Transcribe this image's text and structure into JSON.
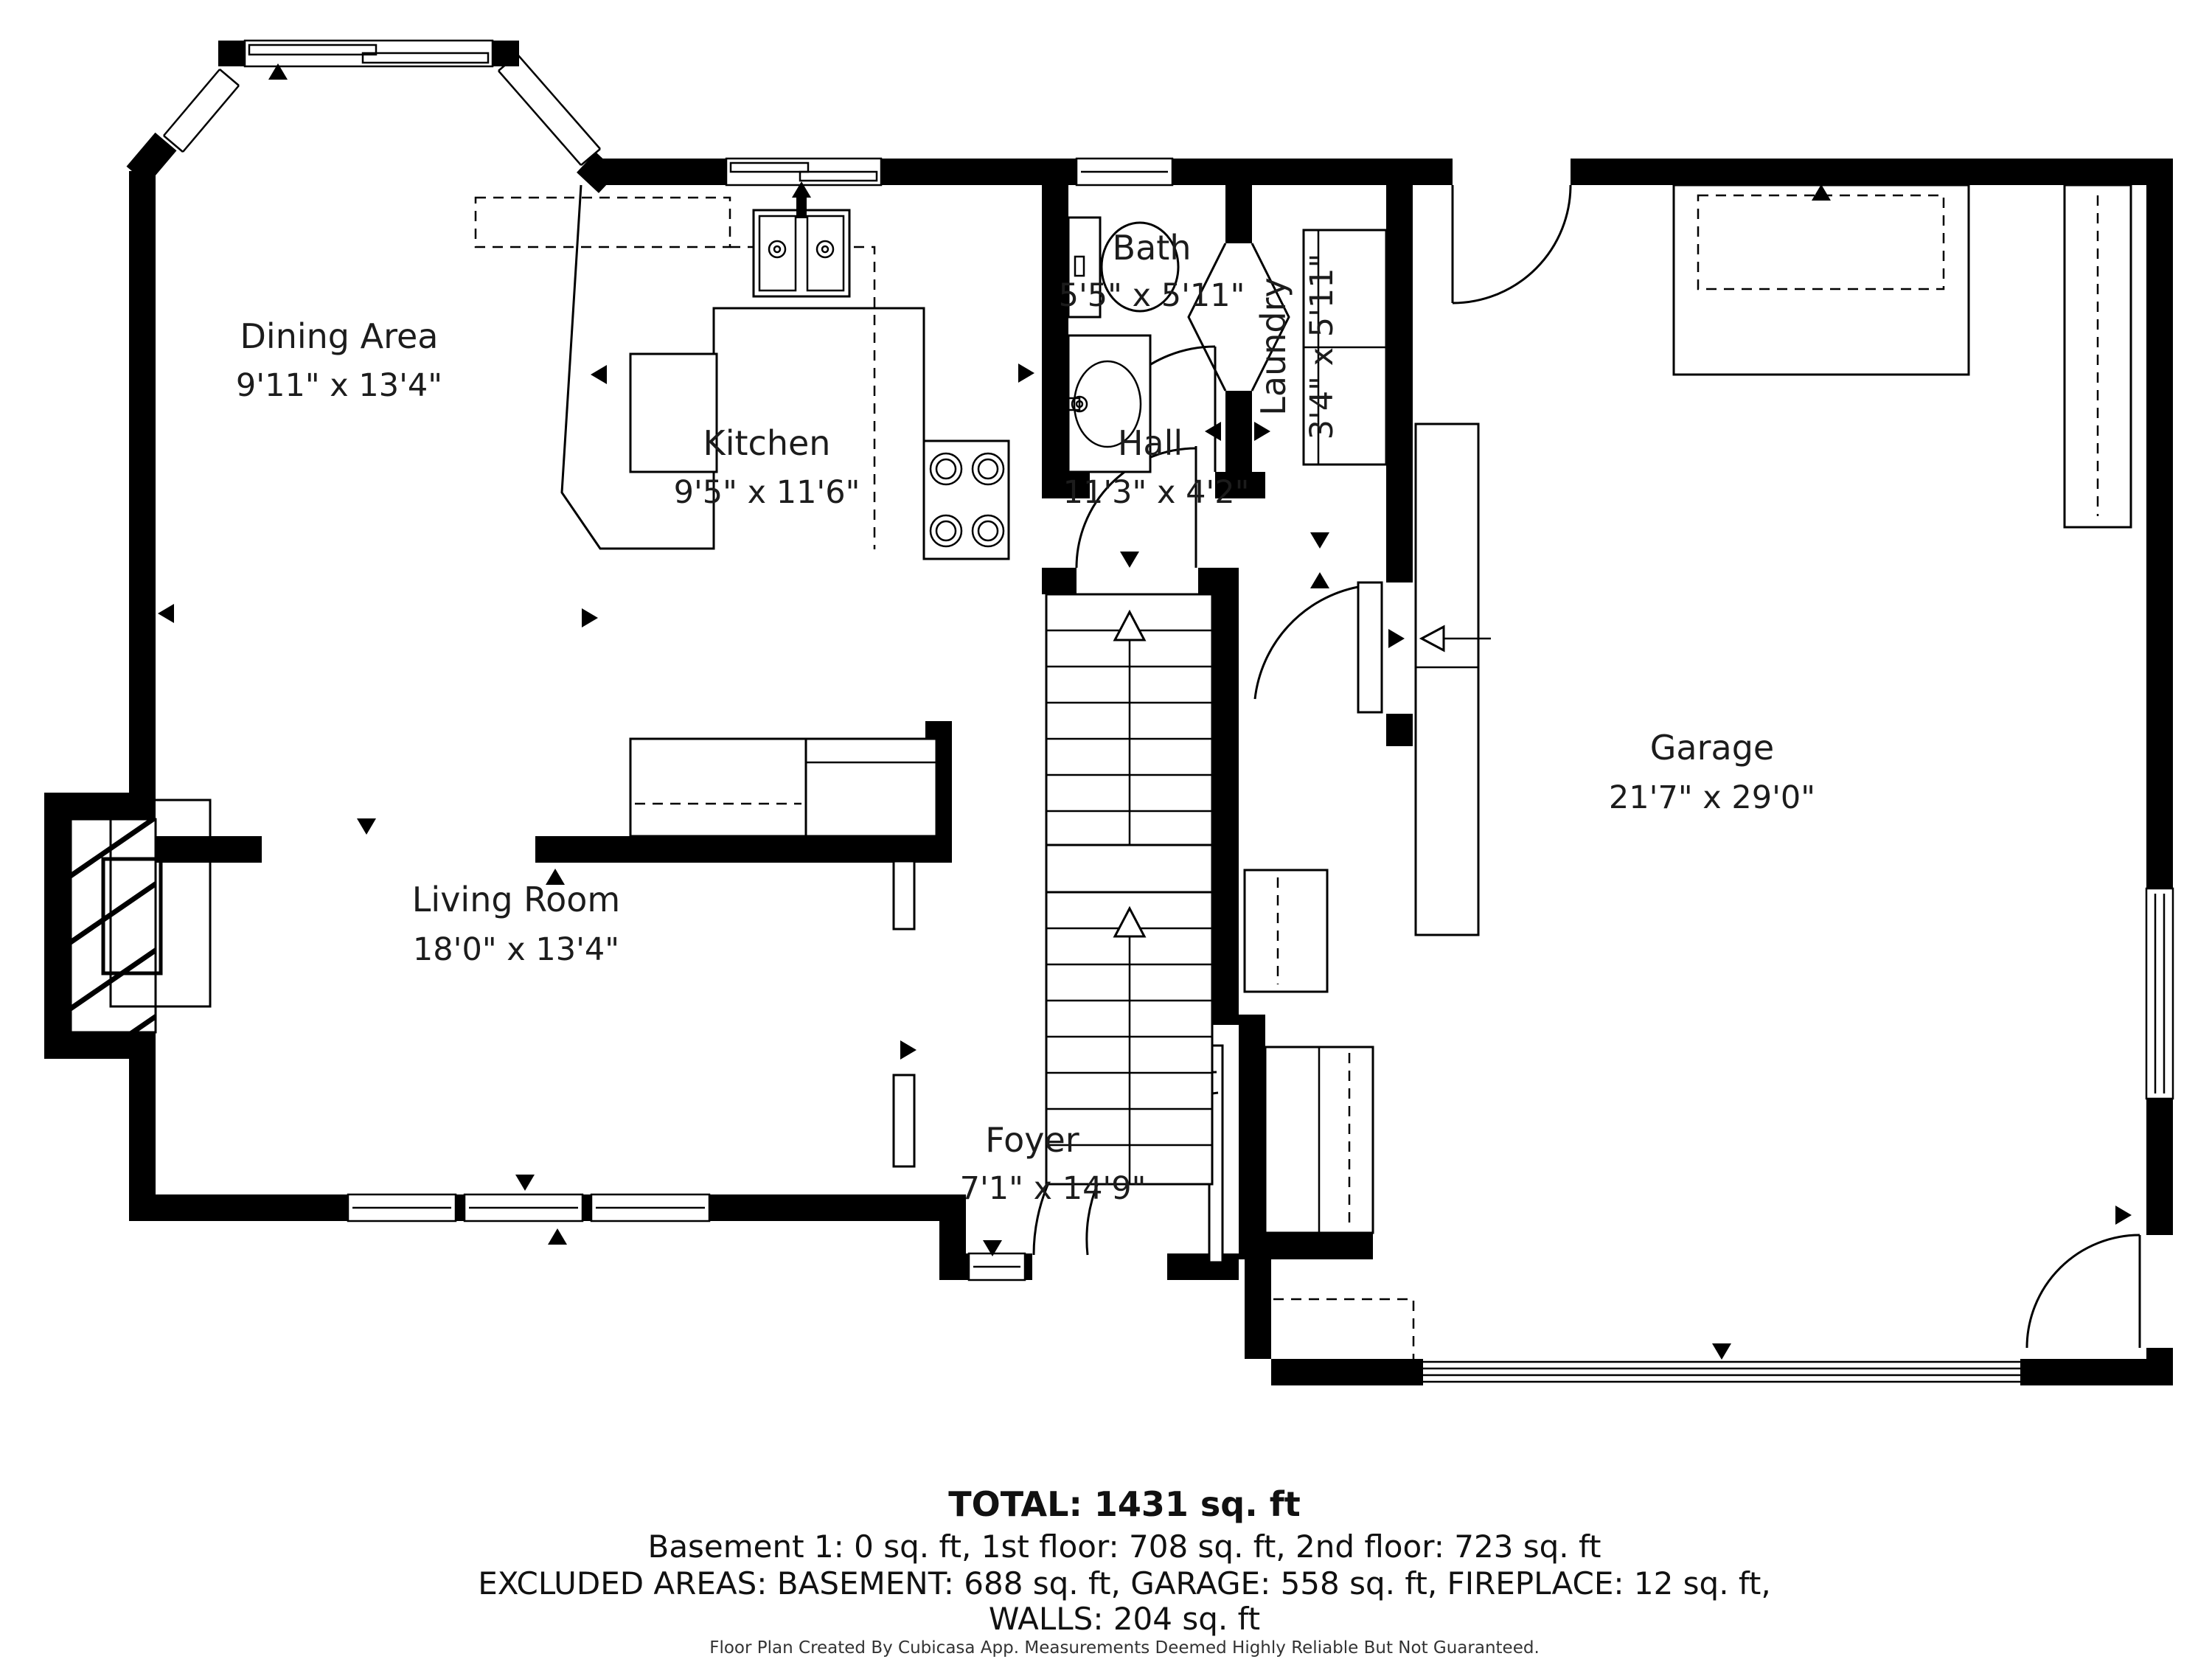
{
  "rooms": {
    "dining": {
      "name": "Dining Area",
      "dims": "9'11\" x 13'4\""
    },
    "kitchen": {
      "name": "Kitchen",
      "dims": "9'5\" x 11'6\""
    },
    "bath": {
      "name": "Bath",
      "dims": "5'5\" x 5'11\""
    },
    "laundry": {
      "name": "Laundry",
      "dims": "3'4\" x 5'11\""
    },
    "hall": {
      "name": "Hall",
      "dims": "11'3\" x 4'2\""
    },
    "living": {
      "name": "Living Room",
      "dims": "18'0\" x 13'4\""
    },
    "foyer": {
      "name": "Foyer",
      "dims": "7'1\" x 14'9\""
    },
    "garage": {
      "name": "Garage",
      "dims": "21'7\" x 29'0\""
    }
  },
  "summary": {
    "total": "TOTAL: 1431 sq. ft",
    "floors": "Basement 1: 0 sq. ft, 1st floor: 708 sq. ft, 2nd floor: 723 sq. ft",
    "excluded": "EXCLUDED AREAS: BASEMENT: 688 sq. ft, GARAGE: 558 sq. ft, FIREPLACE: 12 sq. ft,",
    "walls": "WALLS: 204 sq. ft",
    "footer": "Floor Plan Created By Cubicasa App. Measurements Deemed Highly Reliable But Not Guaranteed."
  },
  "colors": {
    "wall": "#000000",
    "text": "#1c1c1c",
    "background": "#ffffff"
  }
}
